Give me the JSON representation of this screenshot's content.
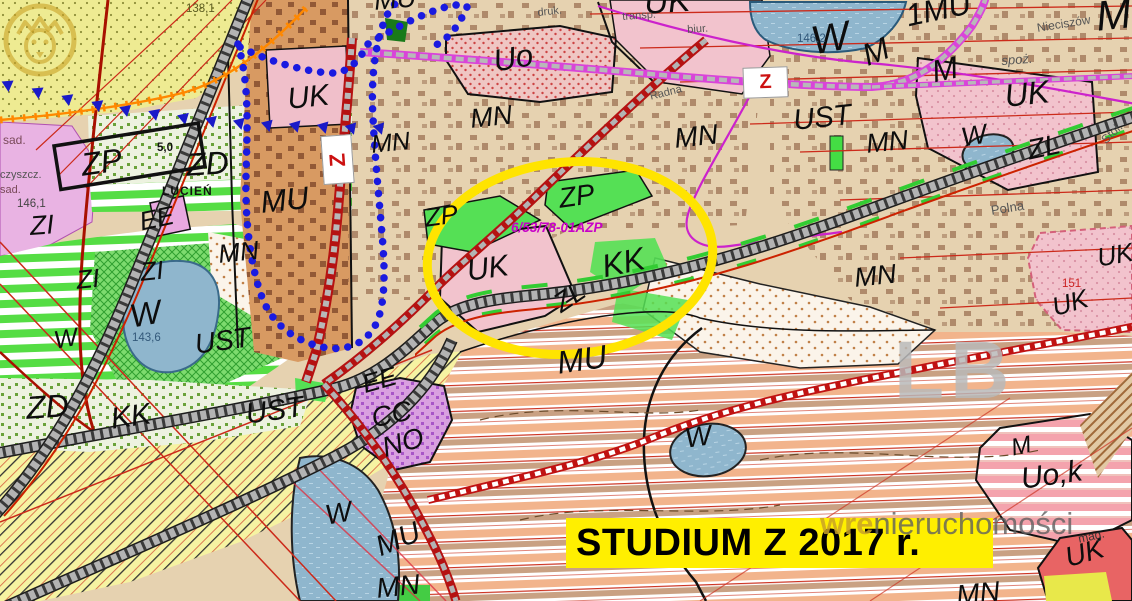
{
  "banner": {
    "text": "STUDIUM Z 2017 r."
  },
  "watermark": {
    "brand_bold": "wre",
    "brand_rest": "nieruchomości",
    "map_letters": "LB",
    "logo": "lion-circle-icon"
  },
  "highlight": {
    "parcel_ref": "6/53/78-01AZP",
    "color": "#ffe400"
  },
  "road_class_markers": [
    "Z",
    "Z"
  ],
  "zone_labels": [
    "MU",
    "UK",
    "Uo",
    "UK",
    "MN",
    "MN",
    "MN",
    "W",
    "1MU",
    "M",
    "M",
    "M",
    "UST",
    "MN",
    "UK",
    "W",
    "ZL",
    "MN",
    "UK",
    "UK",
    "ZD",
    "ZP",
    "MU",
    "ZI",
    "ZI",
    "ZI",
    "EE",
    "MN",
    "W",
    "W",
    "UST",
    "ZD",
    "KK",
    "UST",
    "ZP",
    "ZP",
    "UK",
    "KK",
    "ZL",
    "MU",
    "EE",
    "CC",
    "NO",
    "W",
    "MU",
    "MN",
    "W",
    "MN",
    "M",
    "Uo,k",
    "UK"
  ],
  "place_labels": [
    "LUCIEŃ",
    "Nieciszów",
    "Polna",
    "Stol.",
    "spoż.",
    "druk.",
    "transp.",
    "biur.",
    "Radna",
    "sad.",
    "czyszcz.",
    "sad.",
    "mag."
  ],
  "elevation_labels": [
    "138,1",
    "146,2",
    "146,1",
    "143,6",
    "151",
    "5,0"
  ],
  "colors": {
    "banner_bg": "#ffef00",
    "highlight_ellipse": "#ffe400",
    "planned_road": "#b51212",
    "magenta_road": "#d944d9",
    "boundary_dots": "#1a1ae0",
    "railway": "#b3b3b3",
    "water": "#8fb6cd",
    "forest_yellow": "#eeeb92",
    "green_zone": "#55e055"
  }
}
